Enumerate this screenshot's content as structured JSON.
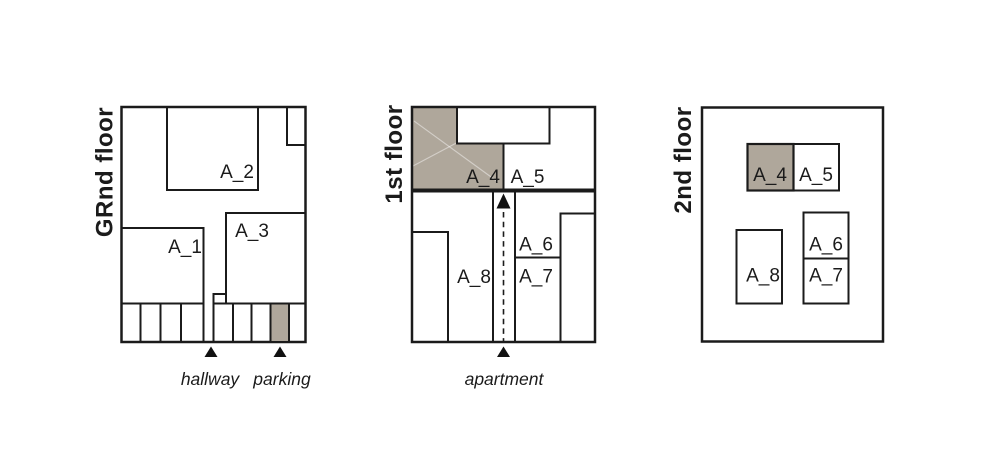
{
  "colors": {
    "shaded_fill": "#afa79b",
    "line": "#1b1b1b",
    "background": "#ffffff"
  },
  "ground_floor": {
    "title": "GRnd floor",
    "rooms": {
      "a1": "A_1",
      "a2": "A_2",
      "a3": "A_3"
    },
    "markers": {
      "hallway": "hallway",
      "parking": "parking"
    }
  },
  "first_floor": {
    "title": "1st floor",
    "rooms": {
      "a4": "A_4",
      "a5": "A_5",
      "a6": "A_6",
      "a7": "A_7",
      "a8": "A_8"
    },
    "markers": {
      "apartment": "apartment"
    }
  },
  "second_floor": {
    "title": "2nd floor",
    "rooms": {
      "a4": "A_4",
      "a5": "A_5",
      "a6": "A_6",
      "a7": "A_7",
      "a8": "A_8"
    }
  }
}
